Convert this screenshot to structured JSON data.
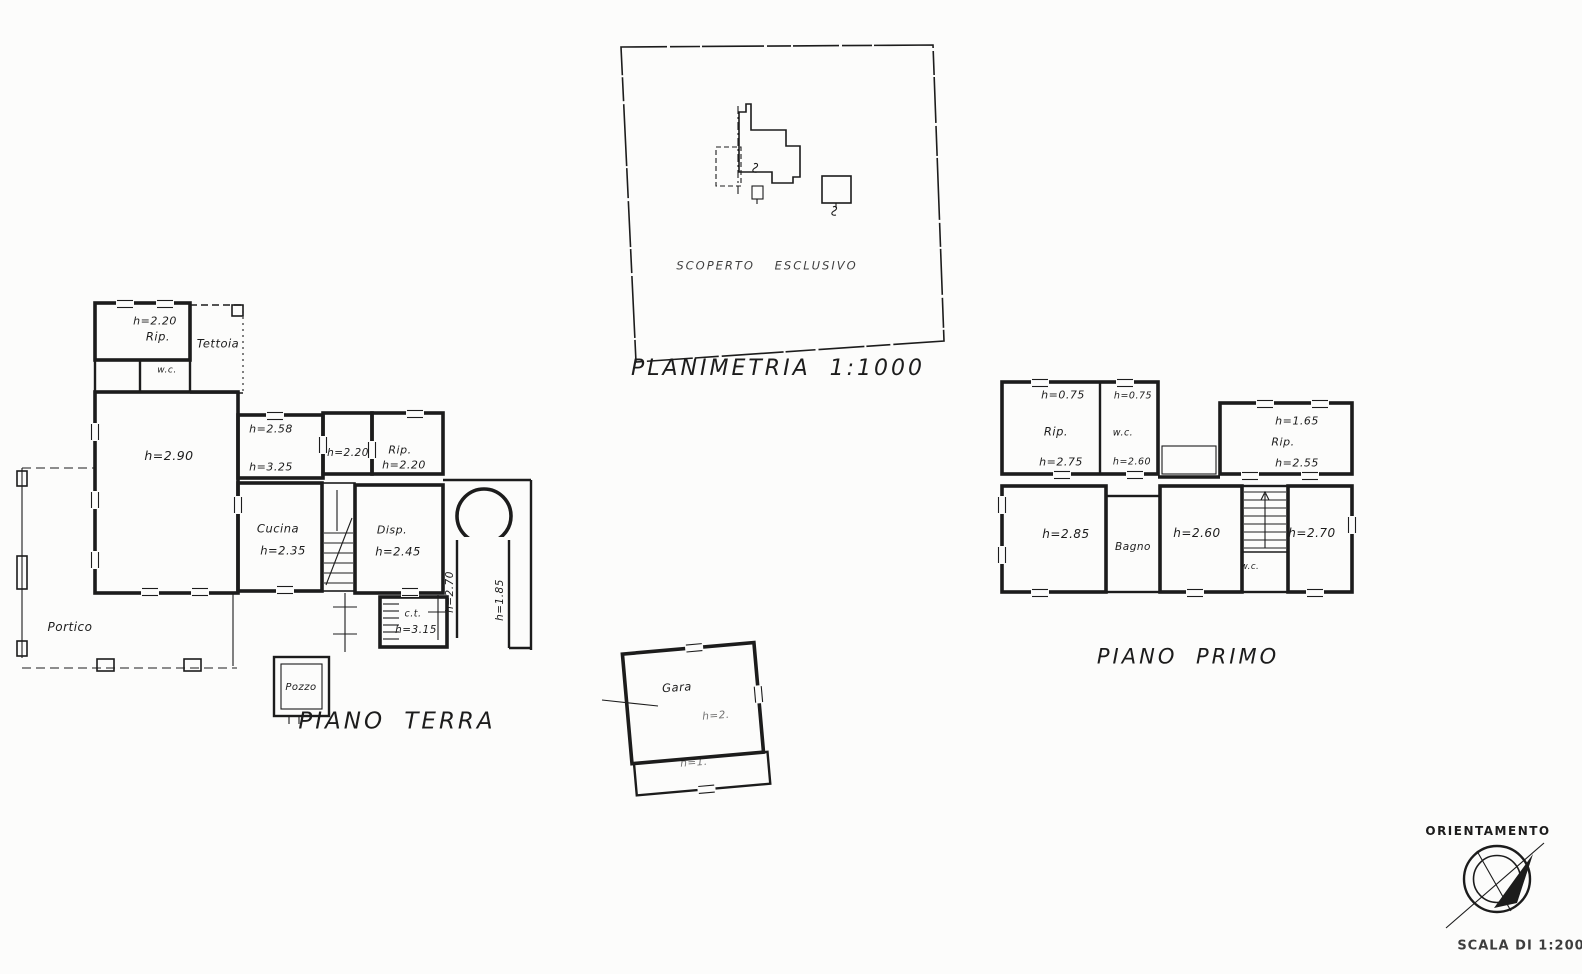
{
  "site_plan": {
    "area_label": "SCOPERTO  ESCLUSIVO",
    "title": "PLANIMETRIA 1:1000"
  },
  "ground_floor": {
    "title": "PIANO  TERRA",
    "rooms": {
      "rip_nw": {
        "label": "Rip.",
        "height": "h=2.20"
      },
      "tettoia": {
        "label": "Tettoia"
      },
      "wc": {
        "label": "w.c."
      },
      "main_room": {
        "height": "h=2.90"
      },
      "room_east": {
        "height_upper": "h=2.58",
        "height_lower": "h=3.25"
      },
      "room_small": {
        "height": "h=2.20"
      },
      "rip_east": {
        "label": "Rip.",
        "height": "h=2.20"
      },
      "cucina": {
        "label": "Cucina",
        "height": "h=2.35"
      },
      "disp": {
        "label": "Disp.",
        "height": "h=2.45"
      },
      "ct": {
        "label": "c.t.",
        "height": "h=3.15"
      },
      "passage": {
        "height_left": "h=2.70",
        "height_right": "h=1.85"
      },
      "portico": {
        "label": "Portico"
      },
      "pozzo": {
        "label": "Pozzo"
      }
    }
  },
  "garage": {
    "label": "Gara",
    "height_main": "h=2.",
    "height_low": "h=1."
  },
  "first_floor": {
    "title": "PIANO  PRIMO",
    "rooms": {
      "rip_nw": {
        "height_top": "h=0.75",
        "label": "Rip.",
        "height": "h=2.75"
      },
      "wc_top": {
        "height_top": "h=0.75",
        "label": "w.c.",
        "height": "h=2.60"
      },
      "rip_ne": {
        "height_top": "h=1.65",
        "label": "Rip.",
        "height": "h=2.55"
      },
      "camera_sw": {
        "height": "h=2.85"
      },
      "bagno": {
        "label": "Bagno"
      },
      "camera_center": {
        "height": "h=2.60"
      },
      "wc_small": {
        "label": "w.c."
      },
      "camera_se": {
        "height": "h=2.70"
      }
    }
  },
  "orientation": {
    "title": "ORIENTAMENTO",
    "scale_label": "SCALA DI 1:200"
  }
}
